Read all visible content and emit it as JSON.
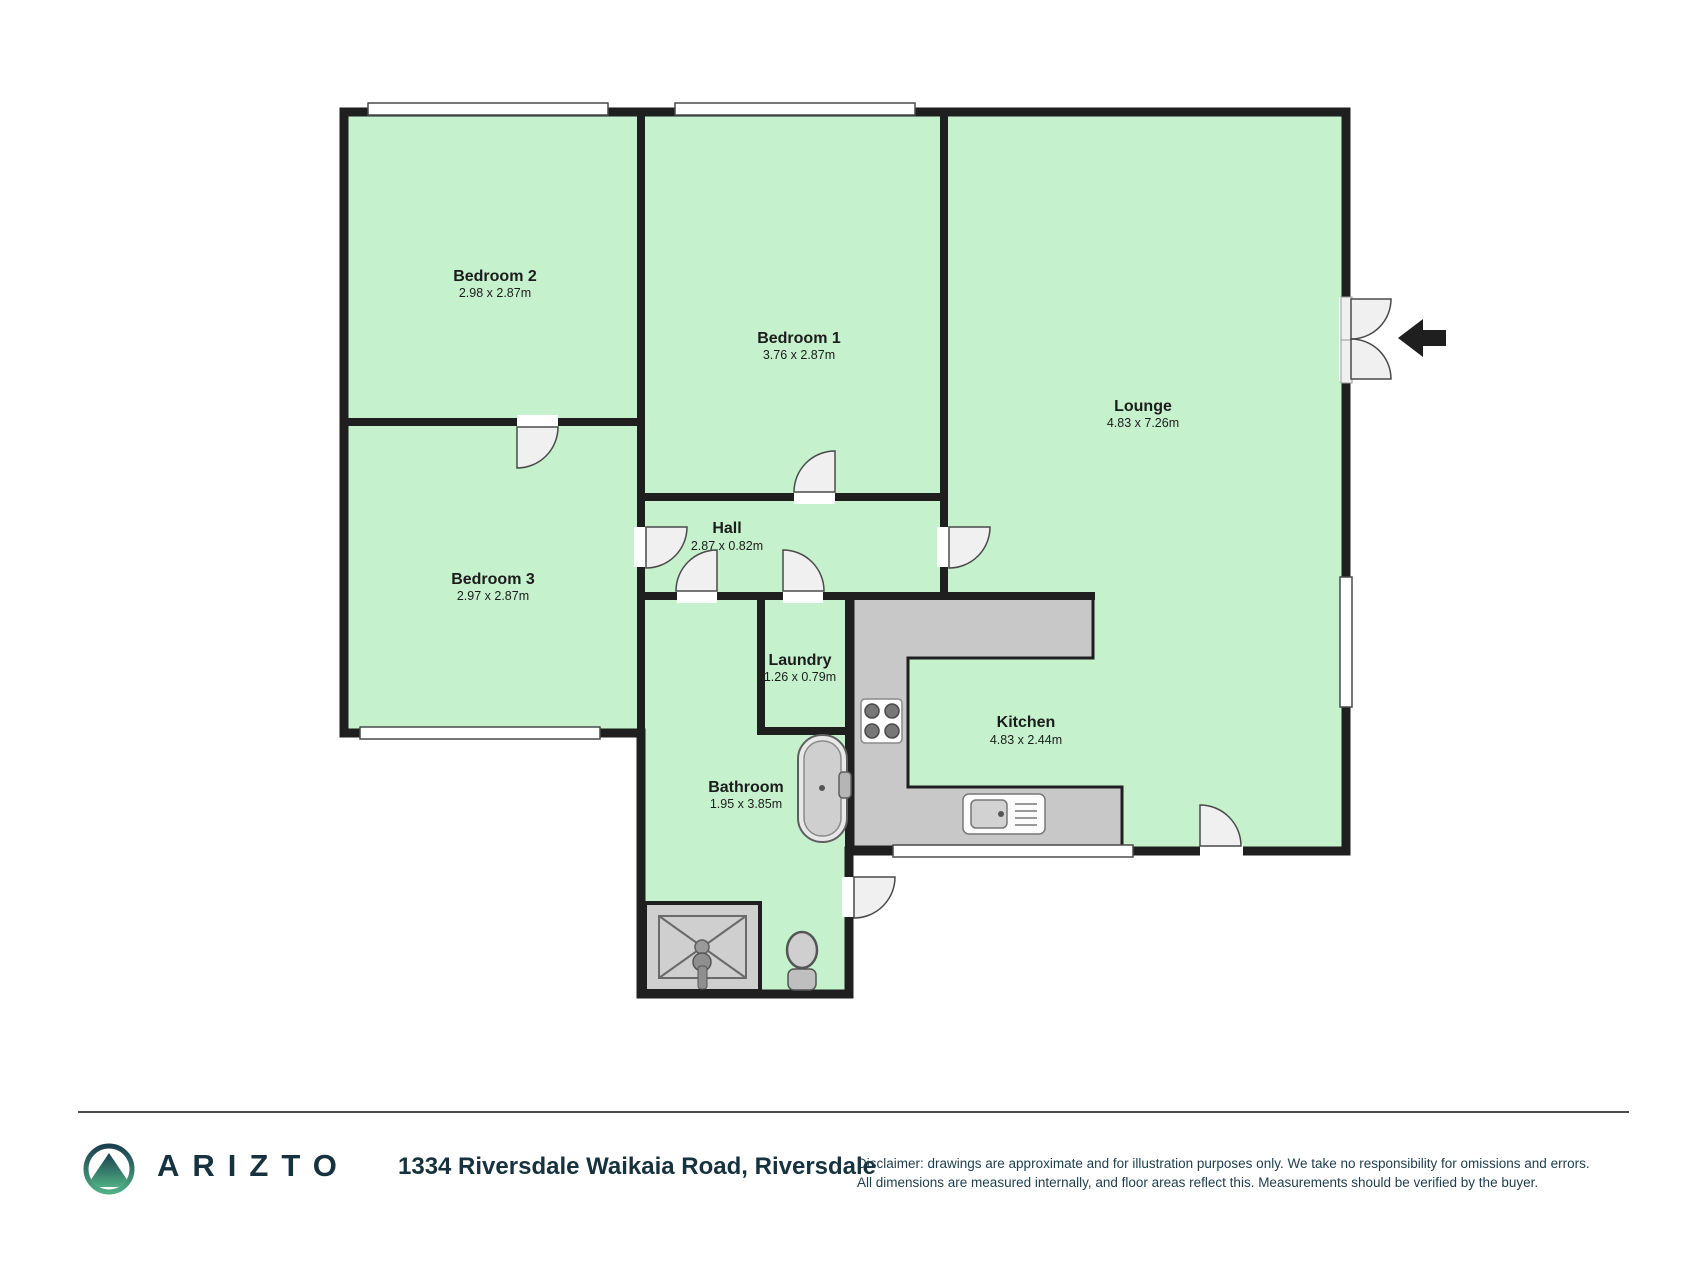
{
  "floorplan": {
    "colors": {
      "wall": "#1f1f1f",
      "room_fill": "#c5f2cd",
      "counter_fill": "#c8c8c8",
      "fixture_fill": "#cfcfcf",
      "door_fill": "#f0f0f0",
      "window_fill": "#ffffff",
      "arrow": "#1f1f1f"
    },
    "rooms": [
      {
        "name": "Bedroom 2",
        "dims": "2.98 x 2.87m"
      },
      {
        "name": "Bedroom 1",
        "dims": "3.76 x 2.87m"
      },
      {
        "name": "Lounge",
        "dims": "4.83 x 7.26m"
      },
      {
        "name": "Bedroom 3",
        "dims": "2.97 x 2.87m"
      },
      {
        "name": "Hall",
        "dims": "2.87 x 0.82m"
      },
      {
        "name": "Laundry",
        "dims": "1.26 x 0.79m"
      },
      {
        "name": "Kitchen",
        "dims": "4.83 x 2.44m"
      },
      {
        "name": "Bathroom",
        "dims": "1.95 x 3.85m"
      }
    ],
    "icons": {
      "entry_arrow": "left-arrow",
      "fixtures": [
        "bathtub",
        "shower",
        "toilet",
        "stove",
        "kitchen-sink"
      ],
      "openings": [
        "door-swing",
        "double-entry-door",
        "window"
      ]
    }
  },
  "footer": {
    "brand": "ARIZTO",
    "logo_icon": "mountain-in-circle",
    "brand_color": "#16323e",
    "logo_gradient_top": "#1b4050",
    "logo_gradient_bottom": "#4fae83",
    "address": "1334 Riversdale Waikaia Road, Riversdale",
    "disclaimer_line1": "Disclaimer: drawings are approximate and for illustration purposes only. We take no responsibility for omissions and errors.",
    "disclaimer_line2": "All dimensions are measured internally, and floor areas reflect this. Measurements should be verified by the buyer."
  }
}
